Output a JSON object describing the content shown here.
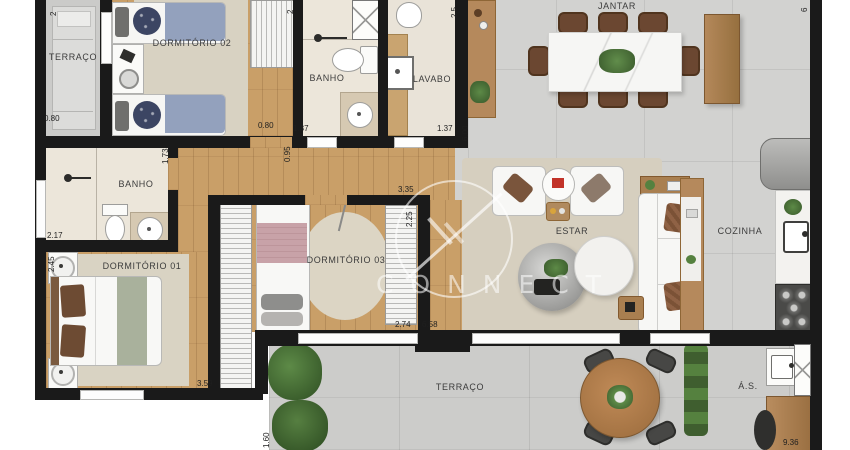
{
  "watermark": {
    "text": "CONNECT"
  },
  "rooms": {
    "terraco_top": {
      "label": "TERRAÇO",
      "width": "0.80",
      "cut_top": "2"
    },
    "dormitorio02": {
      "label": "DORMITÓRIO 02",
      "right": "0.80",
      "wall": "0.95",
      "cut_top": "2"
    },
    "banho_top": {
      "label": "BANHO",
      "width": "1.37"
    },
    "lavabo": {
      "label": "LAVABO",
      "width": "1.37",
      "cut_top": "2.5",
      "height": "6.00"
    },
    "jantar": {
      "label": "JANTAR",
      "cut_right": "6"
    },
    "banho": {
      "label": "BANHO",
      "width": "2.17",
      "door": "1.73"
    },
    "dormitorio01": {
      "label": "DORMITÓRIO 01",
      "width": "3.59",
      "height": "2.45"
    },
    "dormitorio03": {
      "label": "DORMITÓRIO 03",
      "top": "3.35",
      "side": "2.25",
      "width": "2.74",
      "door": "6.58"
    },
    "estar": {
      "label": "ESTAR"
    },
    "cozinha": {
      "label": "COZINHA"
    },
    "terraco_bottom": {
      "label": "TERRAÇO",
      "side": "1.60"
    },
    "area_servico": {
      "label": "Á.S.",
      "width": "9.36"
    }
  },
  "colors": {
    "wall": "#1a1a1a",
    "wood_floor": "#c99f68",
    "tile_floor": "#d2d2d0",
    "rug": "#d8d1c1",
    "bed_blue": "#93a1bd",
    "bed_pink": "#c8a2a8",
    "bed_green": "#a9b19c",
    "furniture_wood": "#a97f50",
    "plant_green": "#4e7a3d"
  }
}
